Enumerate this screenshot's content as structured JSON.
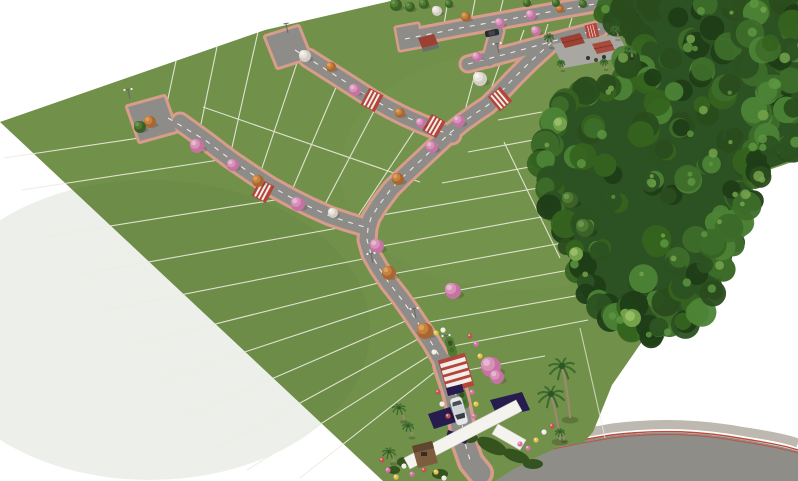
{
  "scene": {
    "type": "3d-aerial-render",
    "subject": "residential land subdivision master plan render",
    "background": "#ffffff",
    "elements": [
      "grass-lots-with-white-boundary-lines",
      "internal-streets-with-dashed-centerlines-and-salmon-sidewalks",
      "red-and-white-pedestrian-crosswalks",
      "flowering-street-trees-pink-orange-white",
      "street-lamps",
      "native-forest-preserve-band",
      "leisure-area-with-red-roof-pavilions-and-palms",
      "entrance-gate-with-white-monument-beam-purple-walls-and-guardhouse",
      "white-car-at-entrance",
      "dark-car-on-upper-street",
      "royal-palm-trees",
      "flower-landscaping-beds",
      "access-highway-with-red-edge-lines"
    ]
  },
  "palette": {
    "background": "#ffffff",
    "grass": "#71904a",
    "grassLight": "#86a356",
    "grassDark": "#5f7c3d",
    "lotLine": "#edecdf",
    "road": "#8d8c89",
    "roadLine": "#ebebe6",
    "curb": "#d79d8a",
    "forestBase": "#2c5122",
    "forestDark": "#1f3d17",
    "forestMid": "#35631f",
    "forestLight": "#4c8336",
    "forestHighlight": "#74a24a",
    "crosswalkRed": "#b5443a",
    "stripeWhite": "#f0efe9",
    "treePink": "#d892b8",
    "treeOrange": "#c5813f",
    "treeWhite": "#e7e3da",
    "treeGreen": "#4e7a33",
    "roofRed": "#9c4034",
    "plaza": "#a9a7a1",
    "gatePurple": "#261c4e",
    "gateWhite": "#f4f3ee",
    "guardBrown": "#7c5d3e",
    "carWhite": "#e6e8ea",
    "carDark": "#2a2a32",
    "highway": "#8f8d88",
    "highwayShoulder": "#bdb9b1",
    "highwayRed": "#c14a38",
    "palmFrond": "#3c6b2e",
    "palmTrunk": "#9b8a70",
    "shrub": "#3a5c28",
    "flowerPink": "#d96fa8",
    "flowerYellow": "#e2c24a",
    "flowerWhite": "#f0ede6",
    "flowerRed": "#c25050"
  }
}
